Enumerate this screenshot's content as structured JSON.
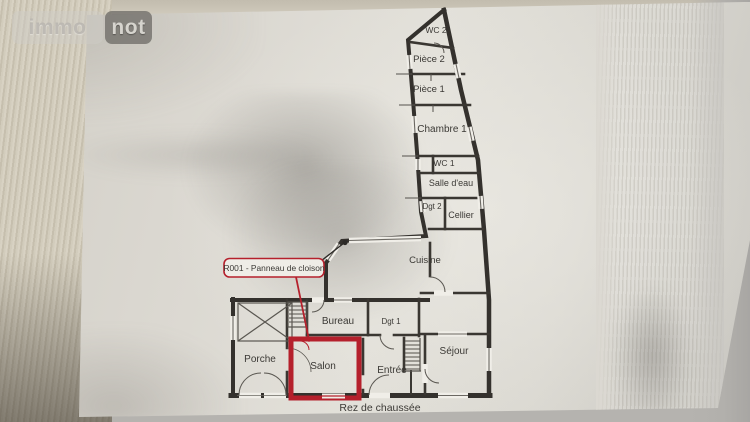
{
  "watermark": {
    "left": "immo",
    "right": "not"
  },
  "plan": {
    "level_label": "Rez de chaussée",
    "callout_label": "R001 - Panneau de cloison",
    "colors": {
      "wall": "#34312d",
      "highlight": "#b5202c",
      "paper_white": "#f0eee8"
    },
    "rooms": [
      {
        "id": "wc2",
        "label": "WC 2"
      },
      {
        "id": "piece2",
        "label": "Pièce 2"
      },
      {
        "id": "piece1",
        "label": "Pièce 1"
      },
      {
        "id": "chambre1",
        "label": "Chambre 1"
      },
      {
        "id": "wc1",
        "label": "WC 1"
      },
      {
        "id": "salle-deau",
        "label": "Salle d'eau"
      },
      {
        "id": "dgt2",
        "label": "Dgt 2"
      },
      {
        "id": "cellier",
        "label": "Cellier"
      },
      {
        "id": "cuisine",
        "label": "Cuisine"
      },
      {
        "id": "bureau",
        "label": "Bureau"
      },
      {
        "id": "dgt1",
        "label": "Dgt 1"
      },
      {
        "id": "porche",
        "label": "Porche"
      },
      {
        "id": "salon",
        "label": "Salon"
      },
      {
        "id": "entree",
        "label": "Entrée"
      },
      {
        "id": "sejour",
        "label": "Séjour"
      }
    ]
  }
}
